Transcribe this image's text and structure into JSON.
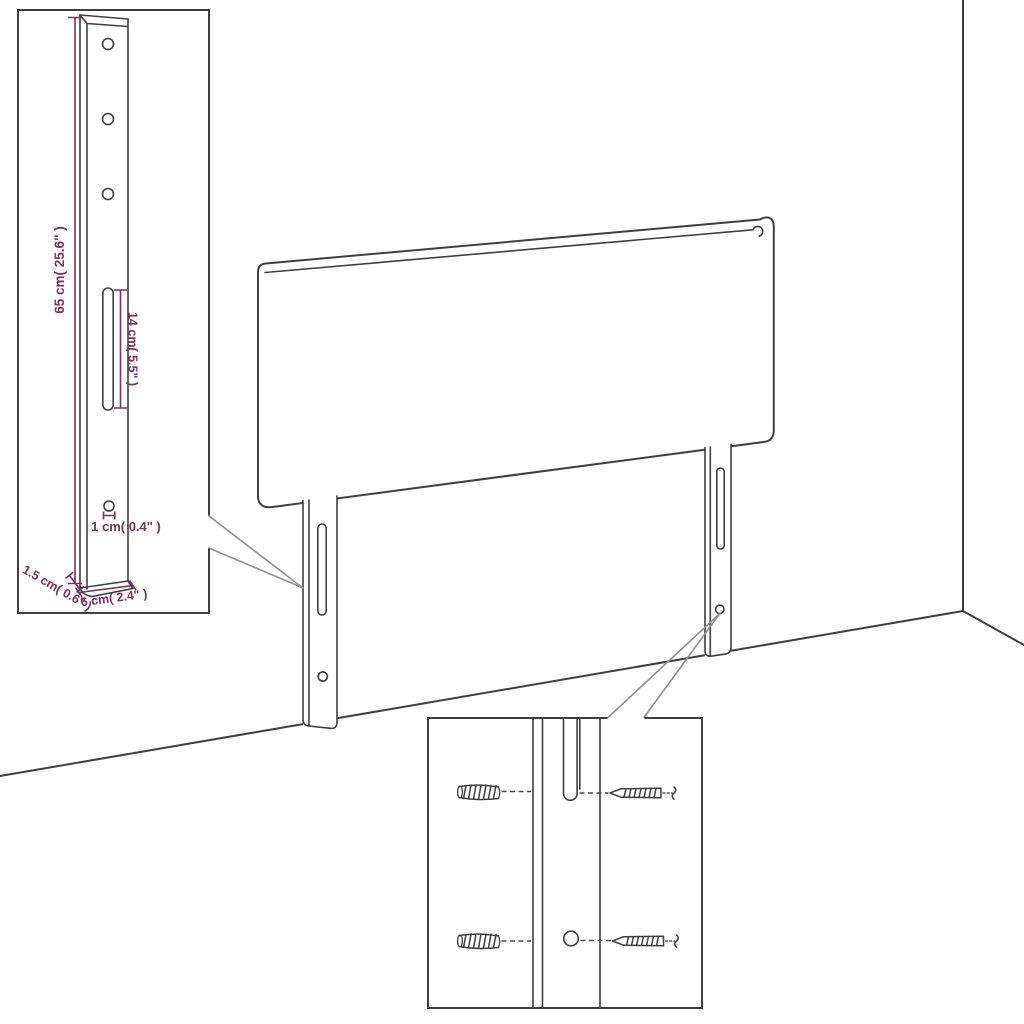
{
  "canvas": {
    "width": 1024,
    "height": 1024,
    "background": "#ffffff"
  },
  "colors": {
    "drawing_line": "#3f3f3f",
    "dimension": "#7e2f63",
    "callout_line": "#8f8f8f"
  },
  "scene": {
    "parts": [
      "headboard-panel",
      "left-mounting-leg",
      "right-mounting-leg",
      "room-corner"
    ]
  },
  "insets": {
    "bracket_detail": {
      "labels": {
        "height": "65 cm( 25.6\" )",
        "slot_length": "14 cm( 5.5\" )",
        "hole_diameter": "1 cm( 0.4\" )",
        "thickness": "1.5 cm( 0.6\" )",
        "width": "6 cm( 2.4\" )"
      },
      "features": [
        "screw-hole",
        "screw-hole",
        "screw-hole",
        "adjustment-slot",
        "fixing-hole"
      ]
    },
    "hardware_detail": {
      "items": [
        "wall-plug-icon",
        "screw-icon",
        "wall-plug-icon",
        "screw-icon"
      ],
      "features": [
        "leg-slot",
        "leg-hole"
      ]
    }
  }
}
